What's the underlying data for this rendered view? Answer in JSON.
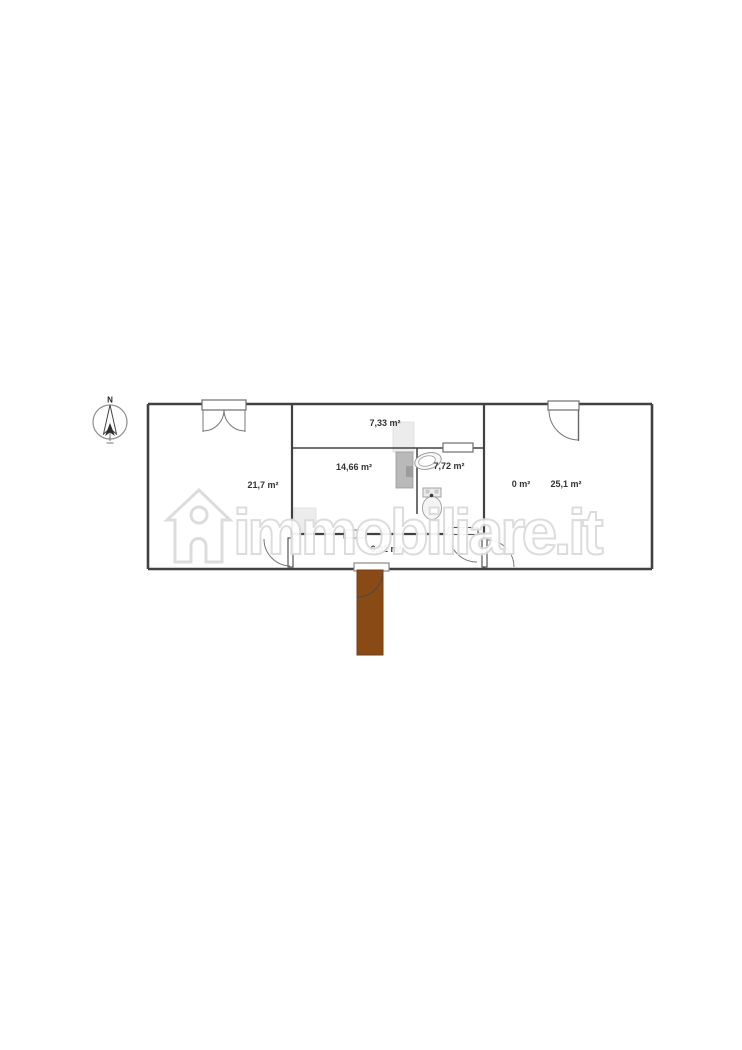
{
  "plan": {
    "compass_label": "N",
    "rooms": [
      {
        "id": "left-room",
        "area_label": "21,7 m²"
      },
      {
        "id": "balcony-strip",
        "area_label": "7,33 m²"
      },
      {
        "id": "main-room",
        "area_label": "14,66 m²"
      },
      {
        "id": "bathroom",
        "area_label": "7,72 m²"
      },
      {
        "id": "zero-area",
        "area_label": "0 m²"
      },
      {
        "id": "right-room",
        "area_label": "25,1 m²"
      },
      {
        "id": "hallway",
        "area_label": "6,02 m²"
      }
    ],
    "colors": {
      "wall": "#414141",
      "stairs_brown": "#8a4a15",
      "fixture_gray": "#b9b9b9",
      "light_gray": "#ececec",
      "watermark_gray": "#dadada"
    }
  },
  "watermark": {
    "text": "immobiliare.it",
    "logo": "house-icon"
  }
}
